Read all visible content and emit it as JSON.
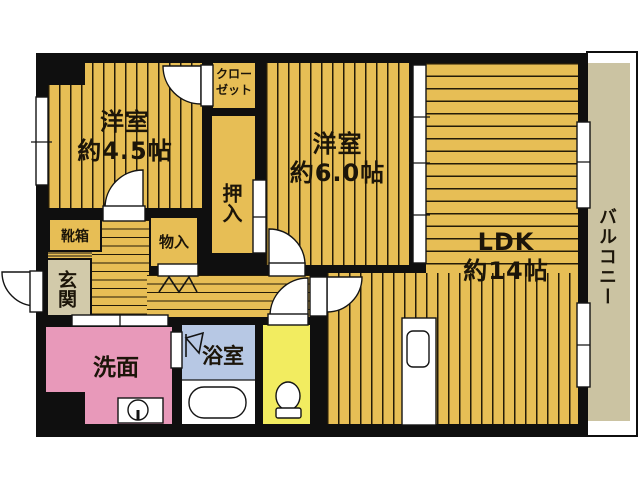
{
  "plan": {
    "type": "apartment-floor-plan",
    "rooms": {
      "western_room_small": {
        "name": "洋室",
        "size": "約4.5帖"
      },
      "western_room_medium": {
        "name": "洋室",
        "size": "約6.0帖"
      },
      "ldk": {
        "name": "LDK",
        "size": "約14帖"
      },
      "closet": {
        "name_line1": "クロー",
        "name_line2": "ゼット"
      },
      "oshiire_closet": {
        "name": "押入"
      },
      "storage": {
        "name": "物入"
      },
      "shoe_box": {
        "name": "靴箱"
      },
      "entrance": {
        "name": "玄関"
      },
      "washroom": {
        "name": "洗面"
      },
      "bathroom": {
        "name": "浴室"
      },
      "balcony": {
        "name": "バルコニー"
      }
    },
    "colors": {
      "floor_gold": "#E7BE55",
      "balcony_beige": "#CBC3A2",
      "entrance_beige": "#D2CAAA",
      "washroom_pink": "#E899BA",
      "bathroom_blue": "#B7C8E4",
      "toilet_yellow": "#F2EC60",
      "wall_black": "#0F0F0F"
    },
    "fixtures": [
      "bathtub",
      "toilet-bowl",
      "wash-basin",
      "washing-machine-area",
      "kitchen-counter-sink",
      "shower-head",
      "bi-fold-door",
      "entrance-step",
      "front-door",
      "windows",
      "sliding-doors",
      "hinged-door-arcs"
    ]
  }
}
